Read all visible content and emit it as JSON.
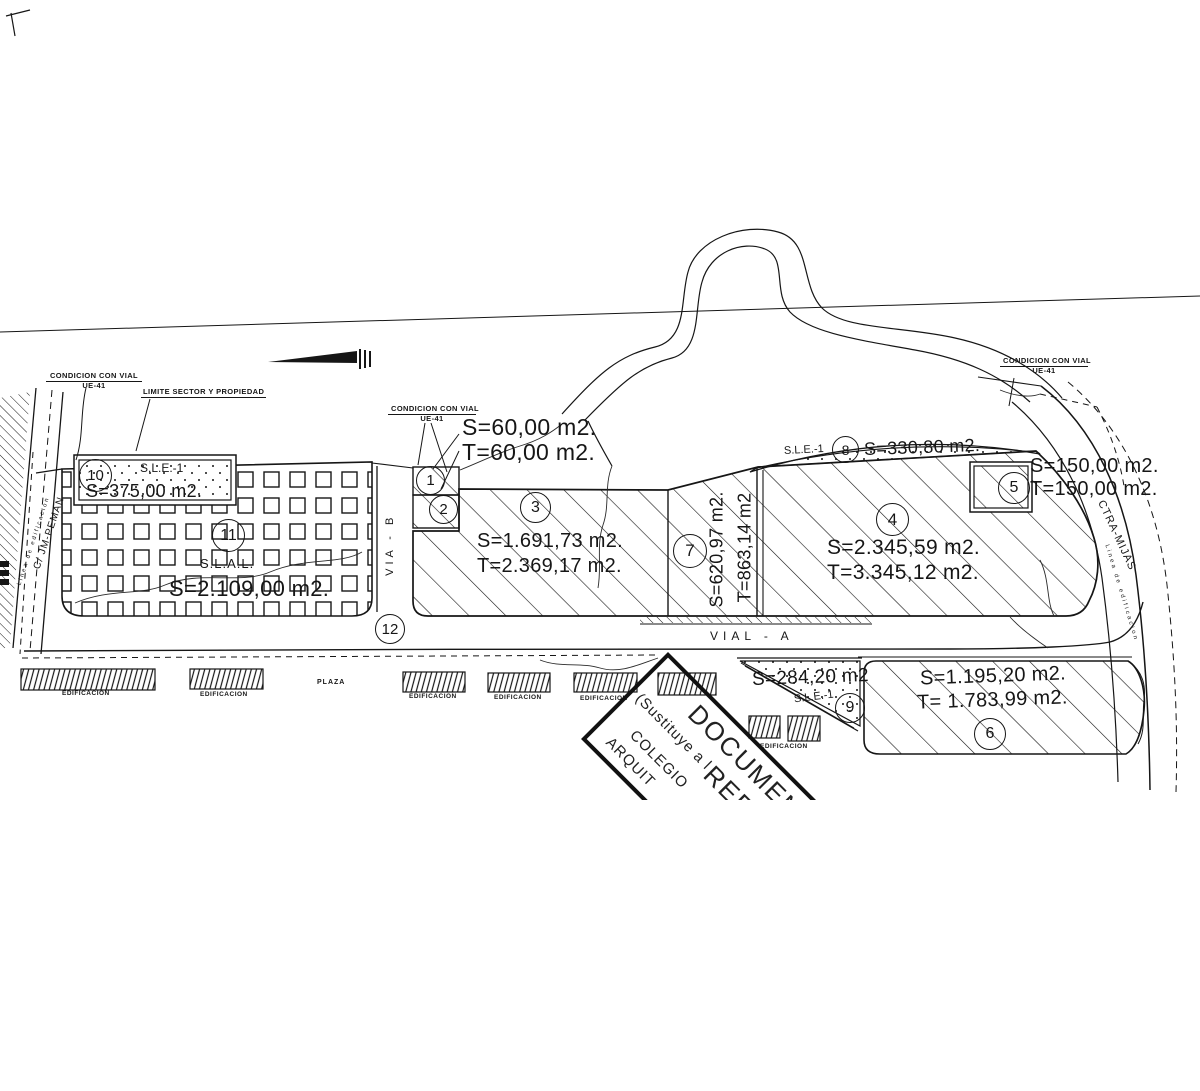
{
  "colors": {
    "ink": "#161616",
    "paper": "#ffffff"
  },
  "labels": {
    "condicion_con_vial": "CONDICION  CON  VIAL",
    "ue41": "UE-41",
    "limite_sector": "LIMITE SECTOR Y PROPIEDAD",
    "vial_a": "VIAL - A",
    "via_b": "VIA - B",
    "ctra_mijas": "CTRA-MIJAS",
    "calle": "C/ JM-PEMAN",
    "linea": "Linea de edificacion",
    "plaza": "PLAZA",
    "edificacion": "EDIFICACION"
  },
  "parcels": {
    "p1": {
      "num": "1"
    },
    "p2": {
      "num": "2"
    },
    "p1p2": {
      "s": "S=60,00 m2.",
      "t": "T=60,00 m2."
    },
    "p3": {
      "num": "3",
      "s": "S=1.691,73 m2.",
      "t": "T=2.369,17 m2."
    },
    "p4": {
      "num": "4",
      "s": "S=2.345,59 m2.",
      "t": "T=3.345,12 m2."
    },
    "p5": {
      "num": "5",
      "s": "S=150,00 m2.",
      "t": "T=150,00 m2."
    },
    "p6": {
      "num": "6",
      "s": "S=1.195,20 m2.",
      "t": "T= 1.783,99 m2."
    },
    "p7": {
      "num": "7",
      "s": "S=620,97 m2.",
      "t": "T=863,14 m2"
    },
    "p8": {
      "num": "8",
      "zone": "S.L.E.-1",
      "s": "S=330,80 m2."
    },
    "p9": {
      "num": "9",
      "zone": "S.L.E.-1",
      "s": "S=284,20 m2"
    },
    "p10": {
      "num": "10",
      "zone": "S.L.E.-1",
      "s": "S=375,00 m2."
    },
    "p11": {
      "num": "11",
      "zone": "S.L.A.L.",
      "s": "S=2.109,00 m2."
    },
    "p12": {
      "num": "12"
    }
  },
  "stamp": {
    "line1": "DOCUMENT",
    "line2": "REFO",
    "line3": "(Sustituye a l",
    "line4": "COLEGIO",
    "line5": "ARQUIT"
  }
}
